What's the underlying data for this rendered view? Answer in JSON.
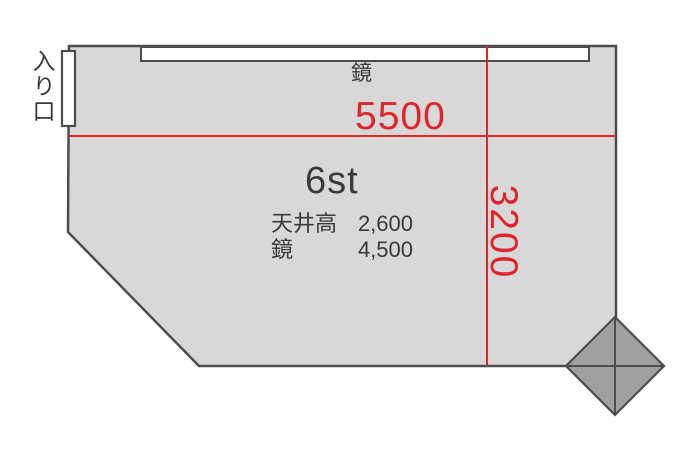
{
  "plan": {
    "entrance_label": "入り口",
    "mirror_label": "鏡",
    "room_name": "6st",
    "width_dimension": "5500",
    "height_dimension": "3200",
    "specs": [
      {
        "label": "天井高",
        "value": "2,600"
      },
      {
        "label": "鏡",
        "value": "4,500"
      }
    ]
  },
  "colors": {
    "room_fill": "#d8d8d8",
    "wall_stroke": "#4d4d4d",
    "fixture_fill": "#ffffff",
    "pillar_fill": "#a0a0a0",
    "dimension_red": "#e1232a",
    "text_dark": "#3a3a3a"
  }
}
